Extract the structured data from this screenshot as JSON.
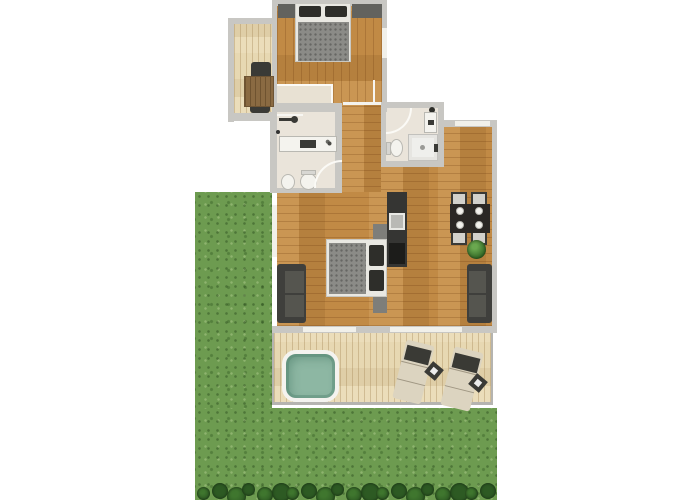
{
  "page": {
    "background": "#ffffff",
    "description": "2D apartment floor plan with top bedroom, study corridor, two bathrooms, open living-dining area with kitchenette, wooden terrace with hot tub and sun loungers, and a large garden lawn with hedge row"
  },
  "colors": {
    "wall": "#c8c7c3",
    "window": "#f1f0ea",
    "wood": "#c18a45",
    "light_wood": "#e7d8b2",
    "tile": "#eae4da",
    "grass": "#6d9b50",
    "hedge_a": "#2d5a23",
    "hedge_b": "#3f762e",
    "water": "#8db7a3",
    "tub_frame": "#f4f3ef",
    "dark": "#3a3a36",
    "sofa": "#3f3f3c",
    "bed_frame": "#e9e8e2",
    "blanket": "#8b8b87",
    "pillow": "#2e2e2a",
    "desk": "#8a6a42",
    "counter": "#353533",
    "steel": "#b9b9b5",
    "plant_a": "#6aa84f",
    "plant_b": "#2f6322",
    "chair": "#d2d1cb",
    "lounger_body": "#dcd4c0",
    "lounger_head": "#3a3a35"
  },
  "floor_plan": {
    "rooms": [
      {
        "name": "bedroom-top",
        "floor": "wood",
        "furniture": [
          "double-bed",
          "pillow",
          "pillow",
          "wardrobe-left",
          "wardrobe-right",
          "dresser"
        ]
      },
      {
        "name": "study-corridor",
        "floor": "light-wood",
        "furniture": [
          "desk",
          "chair",
          "chair"
        ]
      },
      {
        "name": "bathroom-left",
        "floor": "tile",
        "fixtures": [
          "entry-door",
          "vanity-sink",
          "faucet",
          "bidet",
          "toilet",
          "swing-door"
        ]
      },
      {
        "name": "bathroom-right",
        "floor": "tile",
        "fixtures": [
          "swing-door",
          "wash-basin",
          "toilet",
          "shower"
        ]
      },
      {
        "name": "living-sleeping-room",
        "floor": "wood",
        "furniture": [
          "double-bed",
          "nightstand",
          "nightstand",
          "sofa"
        ]
      },
      {
        "name": "kitchenette",
        "fixtures": [
          "counter",
          "sink",
          "cooktop"
        ]
      },
      {
        "name": "dining-area",
        "floor": "wood",
        "furniture": [
          "dining-table",
          "chair",
          "chair",
          "chair",
          "chair",
          "plate",
          "plate",
          "plate",
          "plate",
          "plant",
          "sofa"
        ]
      },
      {
        "name": "terrace",
        "floor": "deck",
        "furniture": [
          "hot-tub",
          "sun-lounger",
          "sun-lounger",
          "side-table",
          "side-table"
        ]
      },
      {
        "name": "garden",
        "features": [
          "lawn-left",
          "lawn-bottom",
          "hedge-row"
        ]
      }
    ],
    "hedge_bush_count": 20
  }
}
